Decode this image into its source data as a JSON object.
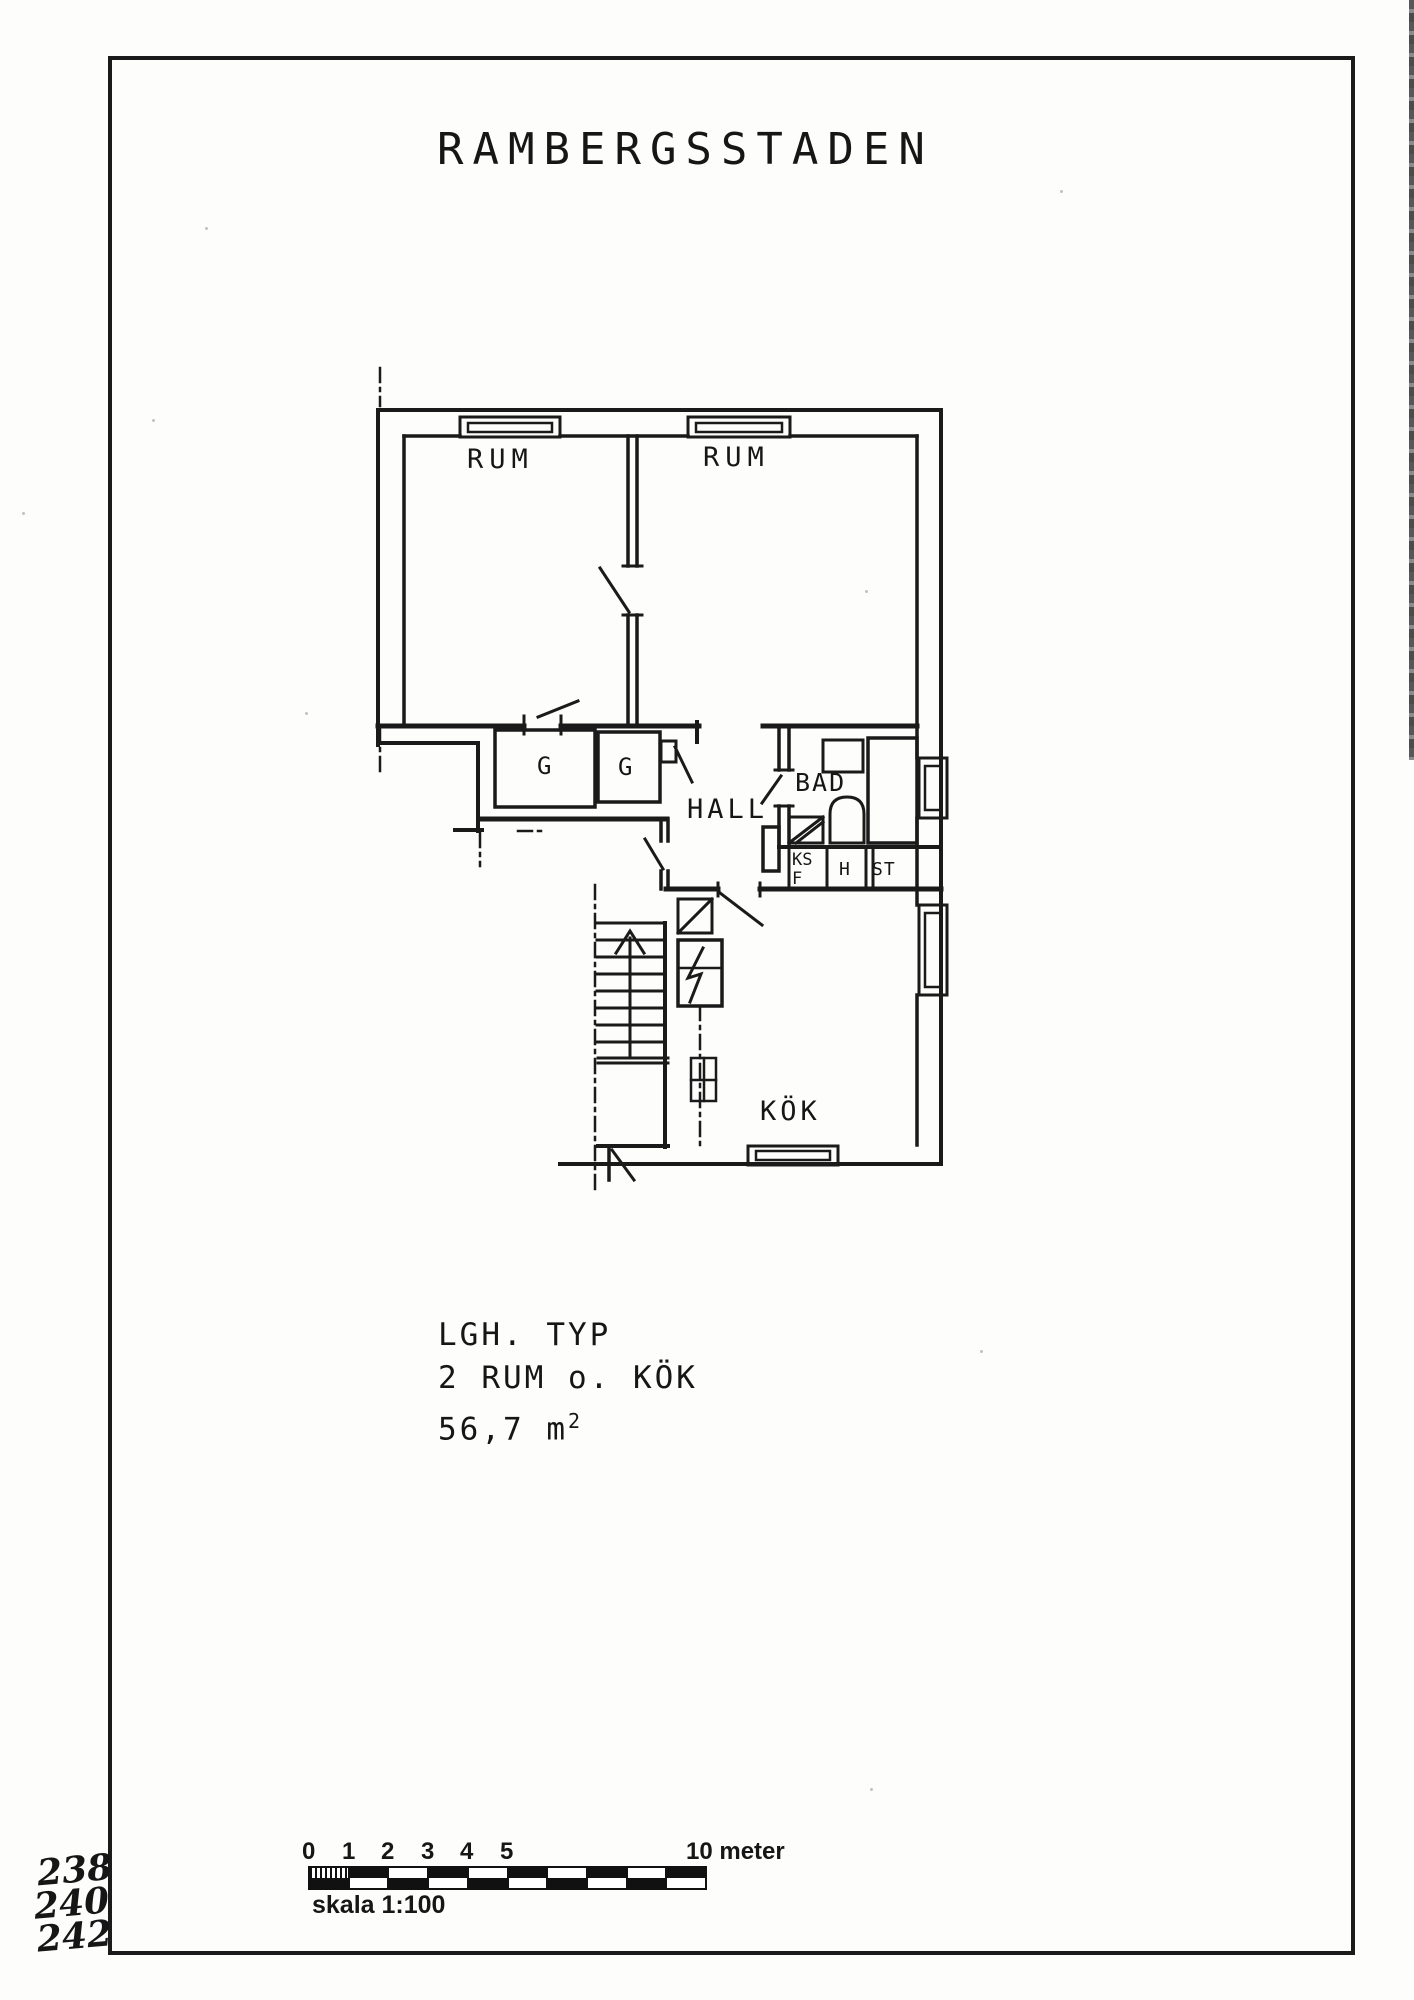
{
  "title": "RAMBERGSSTADEN",
  "plan": {
    "room_labels": {
      "rum1": "RUM",
      "rum2": "RUM",
      "g1": "G",
      "g2": "G",
      "hall": "HALL",
      "bad": "BAD",
      "ks": "KS",
      "f": "F",
      "h": "H",
      "st": "ST",
      "kok": "KÖK"
    }
  },
  "info": {
    "line1": "LGH. TYP",
    "line2": "2 RUM o. KÖK",
    "area_value": "56,7 m",
    "area_sup": "2"
  },
  "scale_bar": {
    "ticks": [
      "0",
      "1",
      "2",
      "3",
      "4",
      "5"
    ],
    "end_label": "10 meter",
    "caption": "skala 1:100"
  },
  "margin_notes": [
    "238",
    "240",
    "242"
  ],
  "colors": {
    "ink": "#1a1a1a",
    "paper": "#fdfdfc"
  }
}
